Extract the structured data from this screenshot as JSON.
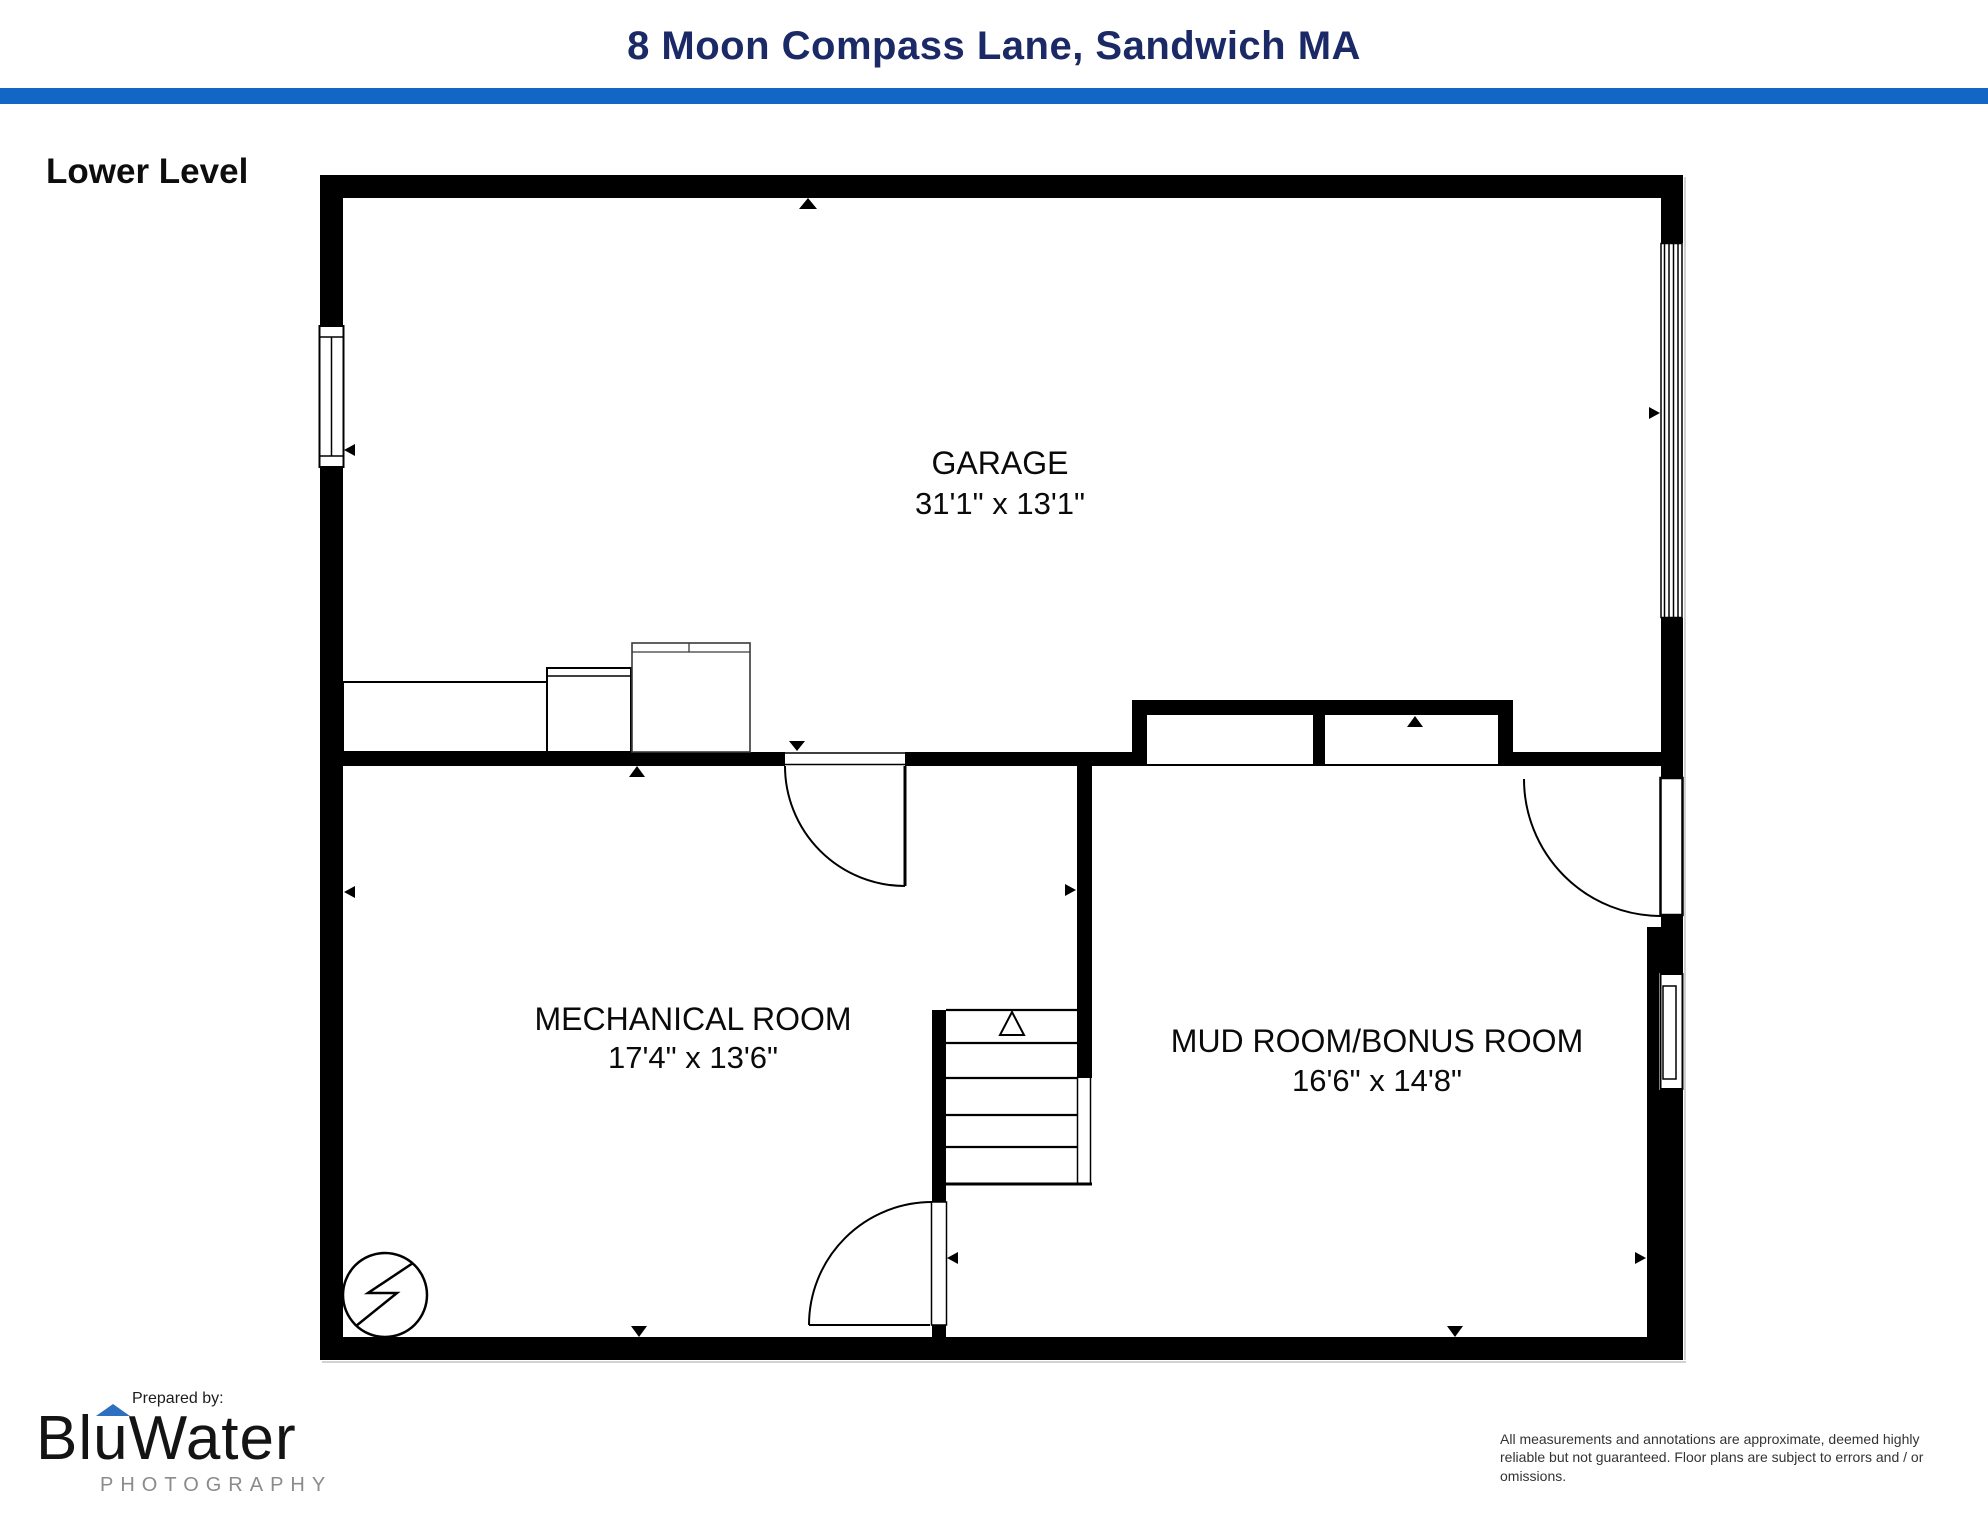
{
  "header": {
    "title": "8 Moon Compass Lane, Sandwich MA"
  },
  "plan": {
    "level_label": "Lower Level",
    "rooms": [
      {
        "name": "GARAGE",
        "dims": "31'1\" x 13'1\""
      },
      {
        "name": "MECHANICAL ROOM",
        "dims": "17'4\" x 13'6\""
      },
      {
        "name": "MUD ROOM/BONUS ROOM",
        "dims": "16'6\" x 14'8\""
      }
    ],
    "features": [
      "garage-door",
      "left-window",
      "right-window",
      "clerestory-windows",
      "stairs-up",
      "electrical-panel",
      "counter",
      "washer",
      "refrigerator"
    ]
  },
  "footer": {
    "prepared_by": "Prepared by:",
    "logo": {
      "blu": "Blu",
      "water": "Water",
      "subtitle": "PHOTOGRAPHY"
    },
    "disclaimer": "All measurements and annotations are approximate, deemed highly reliable but not guaranteed. Floor plans are subject to errors and / or omissions."
  },
  "colors": {
    "accent_blue": "#1266c4",
    "title_navy": "#1b2a66",
    "wall_black": "#000000",
    "logo_roof_blue": "#2e6fc0",
    "logo_gray": "#8b8b8b",
    "disclaimer_gray": "#333333"
  }
}
